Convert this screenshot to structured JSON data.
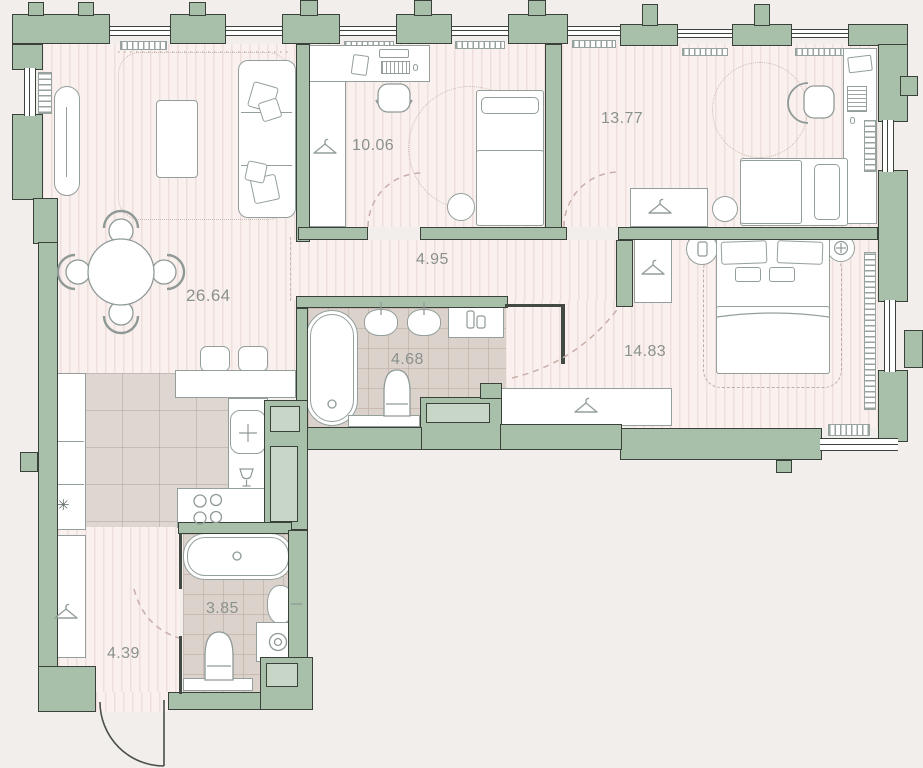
{
  "title": "Apartment floor plan",
  "rooms": [
    {
      "id": "living-kitchen",
      "label": "26.64"
    },
    {
      "id": "bedroom-1",
      "label": "10.06"
    },
    {
      "id": "bedroom-2",
      "label": "13.77"
    },
    {
      "id": "hallway",
      "label": "4.95"
    },
    {
      "id": "master-bedroom",
      "label": "14.83"
    },
    {
      "id": "bathroom",
      "label": "4.68"
    },
    {
      "id": "wc",
      "label": "3.85"
    },
    {
      "id": "entry-hall",
      "label": "4.39"
    }
  ],
  "icons": {
    "fridge_snowflake": "✳"
  },
  "colors": {
    "wall": "#a8c0a9",
    "wall_outline": "#39413a",
    "floor_base": "#faf1ef",
    "floor_stripe": "#eedfdc",
    "bath_floor": "#dbd2cc",
    "kitchen_floor": "#ded6d1",
    "furniture_outline": "#949f9c",
    "label_text": "#8b918b",
    "door_arc": "#c9aea9"
  }
}
